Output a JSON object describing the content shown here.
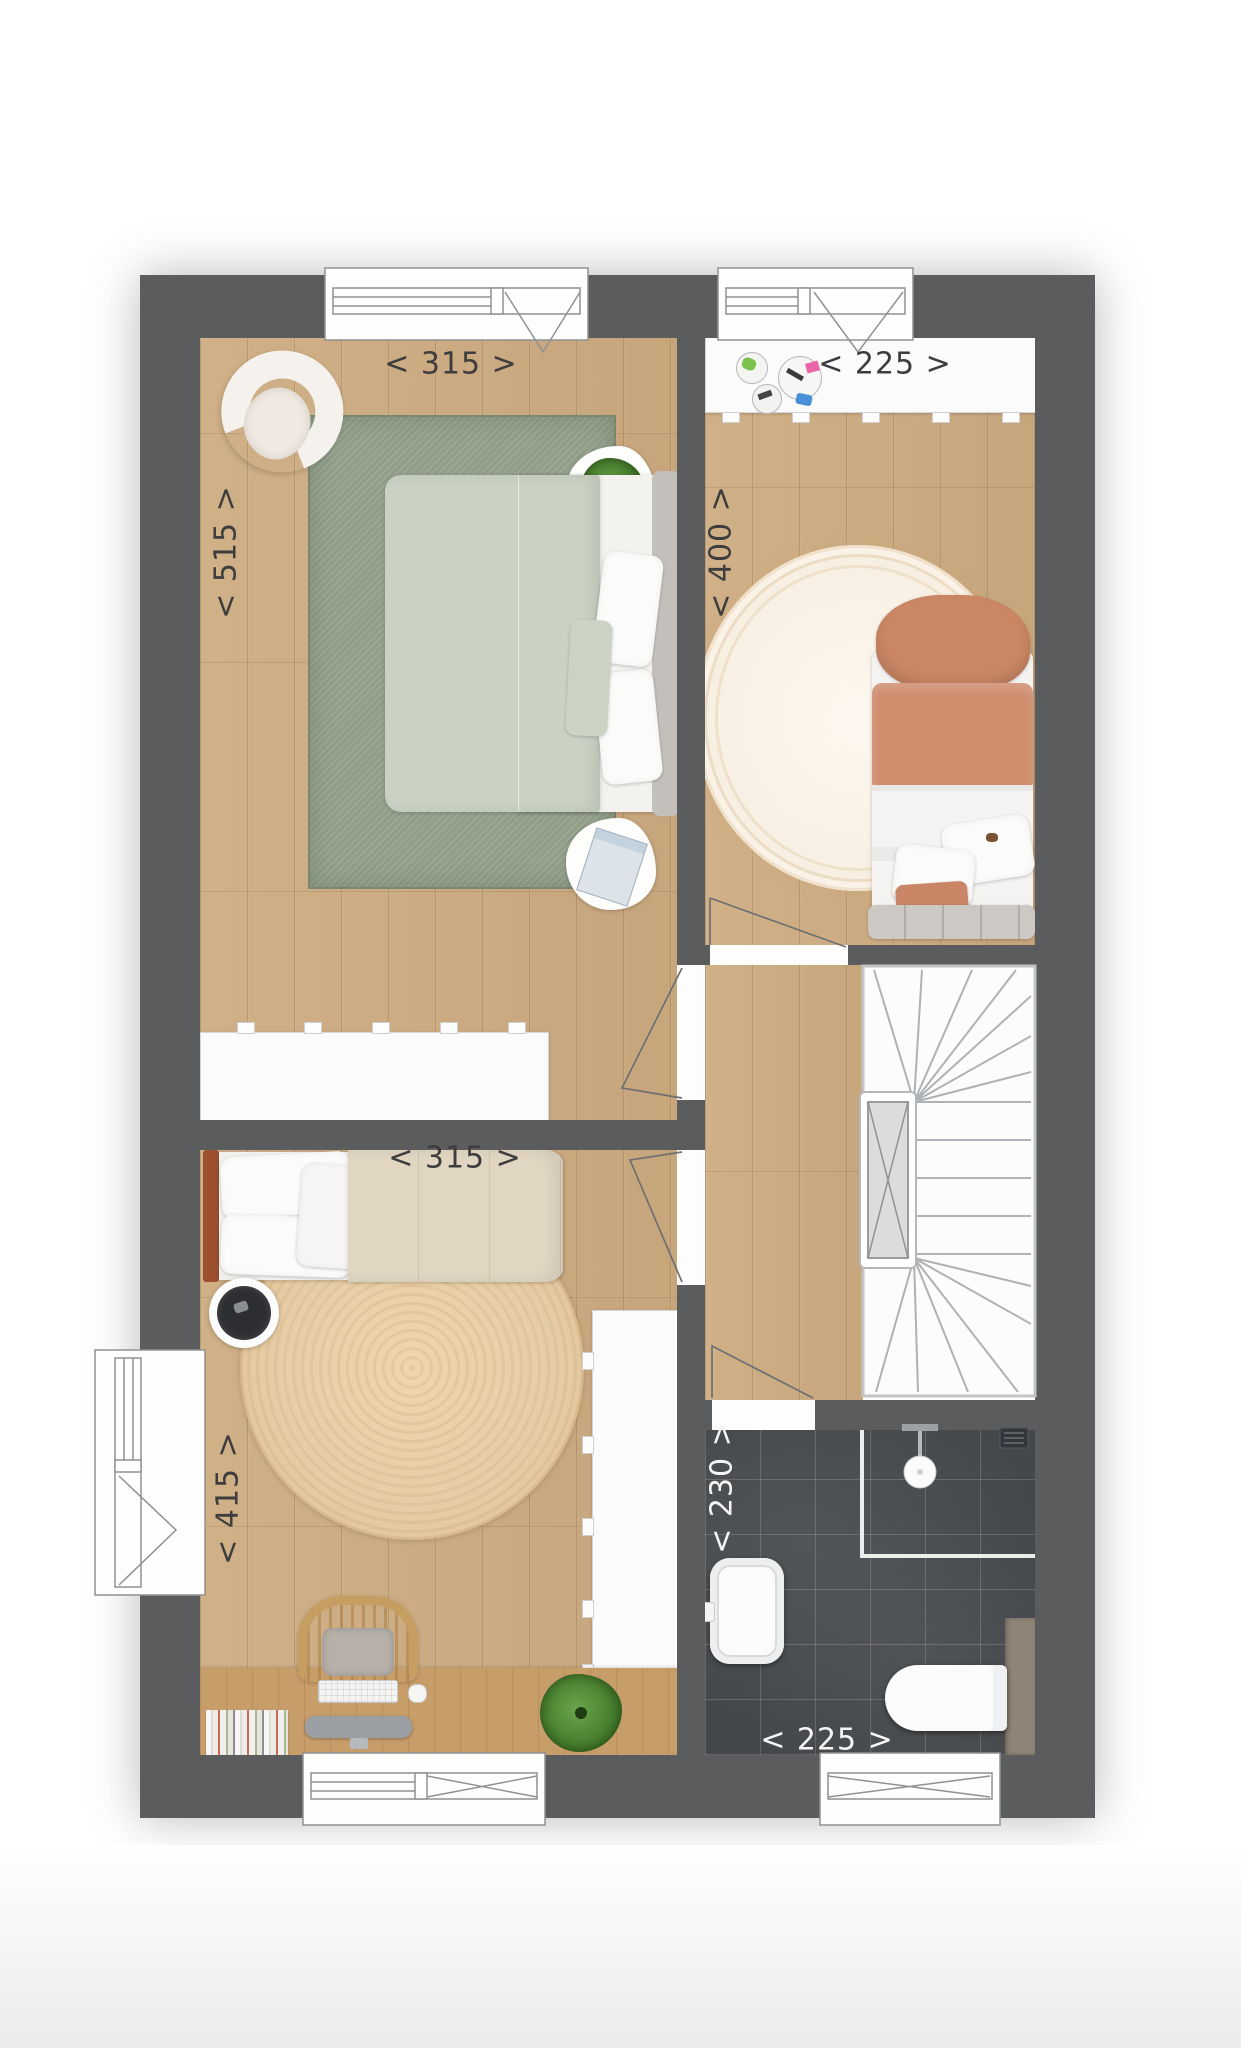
{
  "labels": {
    "bedroom_top_left": {
      "width": "< 315 >",
      "depth": "< 515 >"
    },
    "bedroom_top_right": {
      "width": "< 225 >",
      "depth": "< 400 >"
    },
    "bedroom_bottom_left": {
      "width": "< 315 >",
      "depth": "< 415 >"
    },
    "bathroom": {
      "width": "< 225 >",
      "depth": "< 230 >"
    }
  },
  "colors": {
    "wall": "#5b5c5e",
    "wood_floor": "#cdab80",
    "desk_wood": "#c79d6a",
    "bathroom_tile": "#45484b",
    "rug_green": "#909d87",
    "rug_cream": "#f8efe3",
    "rug_jute": "#e7cda6",
    "bed_sage": "#cbd2c4",
    "bed_terracotta": "#cf8d6e",
    "headboard_rust": "#9c5030",
    "dimension_label_dark": "#3d3d3d",
    "dimension_label_light": "#f5f5f5"
  }
}
